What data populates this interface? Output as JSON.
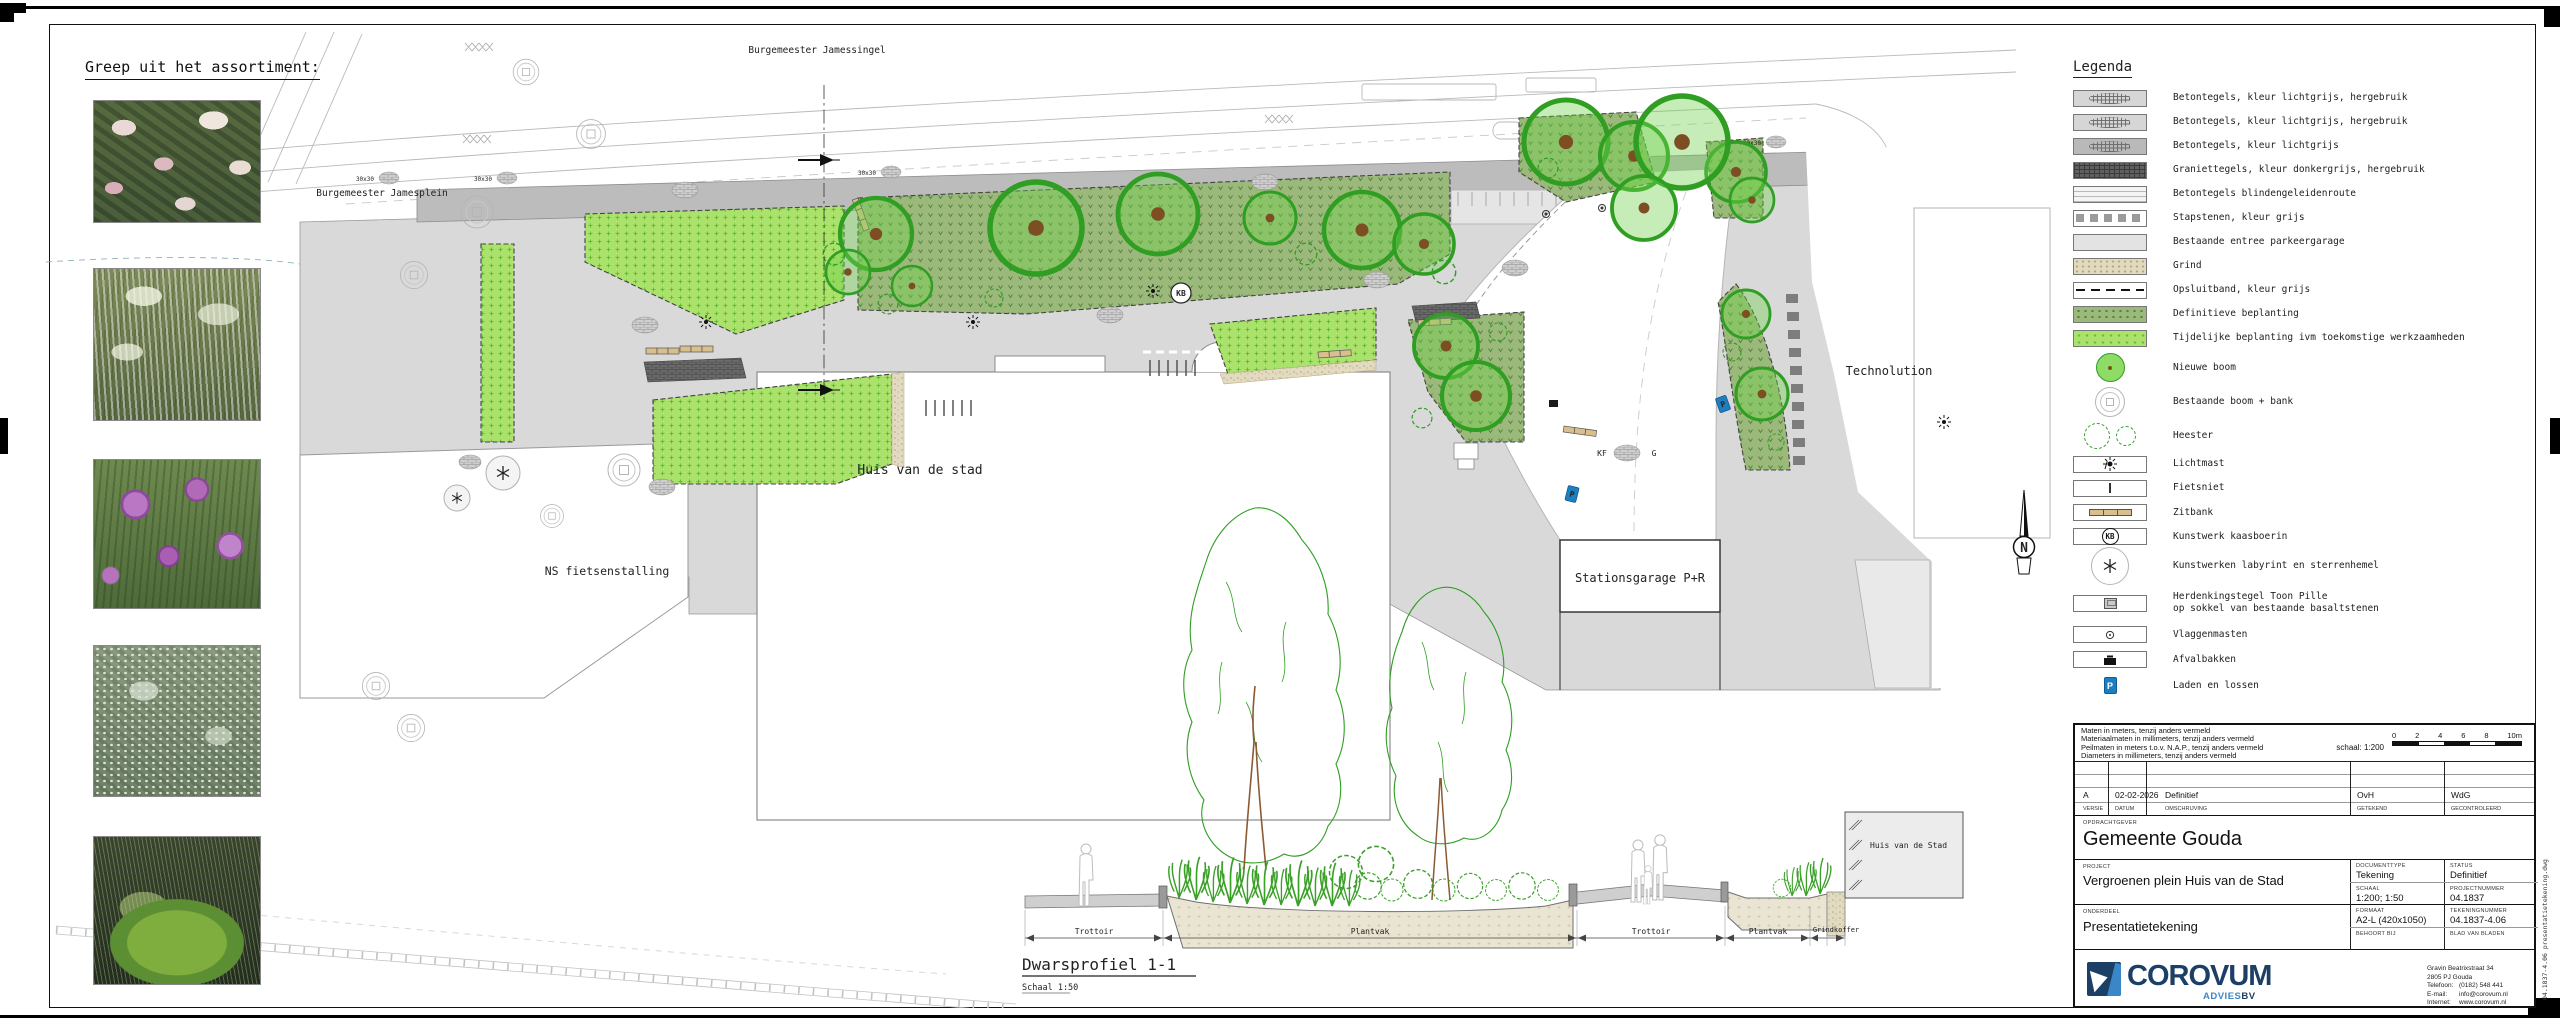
{
  "assortment": {
    "title": "Greep uit het assortiment:"
  },
  "plan": {
    "street_top": "Burgemeester Jamessingel",
    "street_left": "Burgemeester Jamesplein",
    "building_main": "Huis van de stad",
    "bike_parking": "NS fietsenstalling",
    "garage": "Stationsgarage P+R",
    "technolution": "Technolution",
    "north": "N",
    "tree_pit": "30x30",
    "kb": "KB",
    "kf": "KF",
    "g": "G",
    "p": "P"
  },
  "section": {
    "title": "Dwarsprofiel 1-1",
    "scale": "Schaal 1:50",
    "building_label": "Huis van de Stad",
    "dim1": "Trottoir",
    "dim2": "Plantvak",
    "dim3": "Trottoir",
    "dim4": "Plantvak",
    "dim5": "Grindkoffer"
  },
  "legend": {
    "title": "Legenda",
    "kb": "KB",
    "p": "P",
    "items": [
      {
        "label": "Betontegels, kleur lichtgrijs, hergebruik"
      },
      {
        "label": "Betontegels, kleur lichtgrijs, hergebruik"
      },
      {
        "label": "Betontegels, kleur lichtgrijs"
      },
      {
        "label": "Graniettegels, kleur donkergrijs, hergebruik"
      },
      {
        "label": "Betontegels blindengeleidenroute"
      },
      {
        "label": "Stapstenen, kleur grijs"
      },
      {
        "label": "Bestaande entree parkeergarage"
      },
      {
        "label": "Grind"
      },
      {
        "label": "Opsluitband, kleur grijs"
      },
      {
        "label": "Definitieve beplanting"
      },
      {
        "label": "Tijdelijke beplanting ivm toekomstige werkzaamheden"
      },
      {
        "label": "Nieuwe boom"
      },
      {
        "label": "Bestaande boom + bank"
      },
      {
        "label": "Heester"
      },
      {
        "label": "Lichtmast"
      },
      {
        "label": "Fietsniet"
      },
      {
        "label": "Zitbank"
      },
      {
        "label": "Kunstwerk kaasboerin"
      },
      {
        "label": "Kunstwerken labyrint en sterrenhemel"
      },
      {
        "label": "Herdenkingstegel Toon Pille",
        "label2": "op sokkel van bestaande basaltstenen"
      },
      {
        "label": "Vlaggenmasten"
      },
      {
        "label": "Afvalbakken"
      },
      {
        "label": "Laden en lossen"
      }
    ]
  },
  "titleblock": {
    "notes": [
      "Maten in meters, tenzij anders vermeld",
      "Materiaalmaten in millimeters, tenzij anders vermeld",
      "Peilmaten in meters t.o.v. N.A.P., tenzij anders vermeld",
      "Diameters in millimeters, tenzij anders vermeld"
    ],
    "scale_label": "schaal: 1:200",
    "ticks": [
      "0",
      "2",
      "4",
      "6",
      "8",
      "10m"
    ],
    "rev": {
      "versie": "A",
      "datum": "02-02-2026",
      "omschrijving": "Definitief",
      "getekend": "OvH",
      "gecontroleerd": "WdG"
    },
    "rev_headers": {
      "versie": "VERSIE",
      "datum": "DATUM",
      "omschrijving": "OMSCHRIJVING",
      "getekend": "GETEKEND",
      "gecontroleerd": "GECONTROLEERD"
    },
    "opdrachtgever_label": "OPDRACHTGEVER",
    "opdrachtgever": "Gemeente Gouda",
    "project_label": "PROJECT",
    "project": "Vergroenen plein Huis van de Stad",
    "documenttype_label": "DOCUMENTTYPE",
    "documenttype": "Tekening",
    "status_label": "STATUS",
    "status": "Definitief",
    "schaal_label": "SCHAAL",
    "schaal": "1:200; 1:50",
    "projectnummer_label": "PROJECTNUMMER",
    "projectnummer": "04.1837",
    "onderdeel_label": "ONDERDEEL",
    "onderdeel": "Presentatietekening",
    "formaat_label": "FORMAAT",
    "formaat": "A2-L (420x1050)",
    "tekeningnummer_label": "TEKENINGNUMMER",
    "tekeningnummer": "04.1837-4.06",
    "behoort_label": "BEHOORT BIJ",
    "blad_label": "BLAD VAN BLADEN",
    "file_vertical": "04.1837-4.06 presentatietekening.dwg",
    "company": {
      "name": "COROVUM",
      "advies": "ADVIES",
      "bv": "BV",
      "address1": "Gravin Beatrixstraat 34",
      "address2": "2805 PJ Gouda",
      "tel_label": "Telefoon:",
      "tel": "(0182) 548 441",
      "email_label": "E-mail:",
      "email": "info@corovum.nl",
      "web_label": "Internet:",
      "web": "www.corovum.nl"
    }
  }
}
